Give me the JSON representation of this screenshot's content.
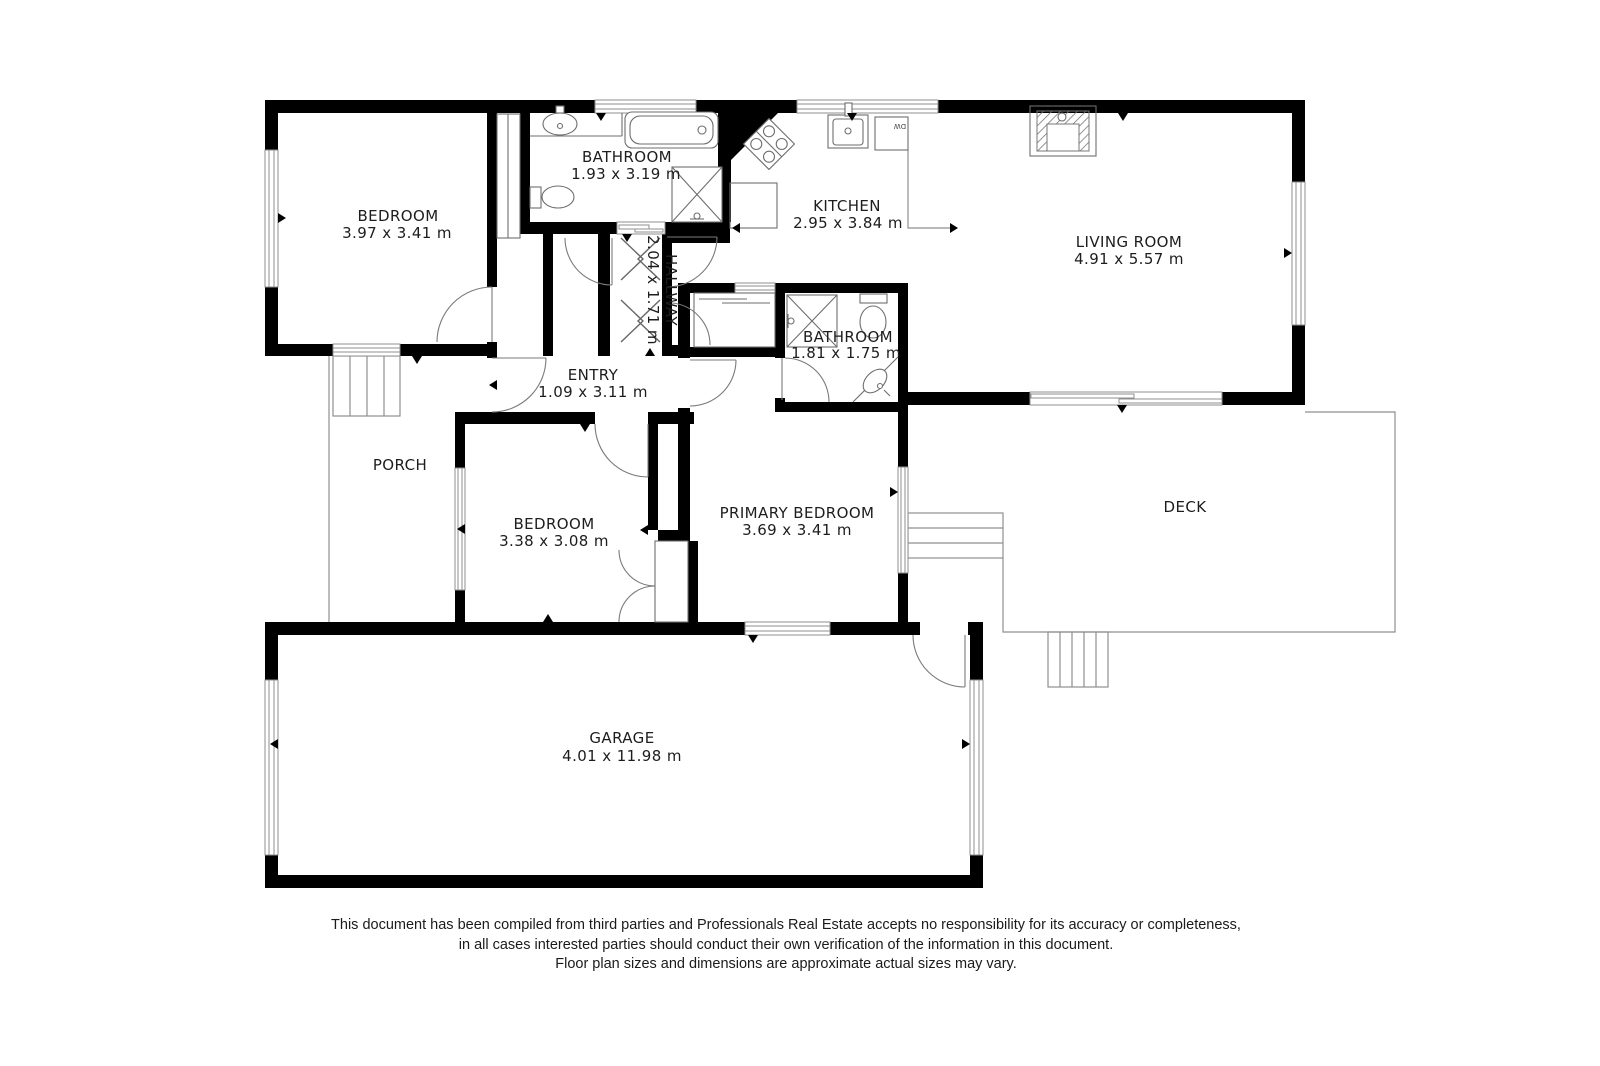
{
  "colors": {
    "bg": "#ffffff",
    "wall": "#000000",
    "line": "#8f8f8f",
    "fixture": "#6e6e6e",
    "text": "#1d1d1d"
  },
  "rooms": {
    "bedroom1": {
      "name": "BEDROOM",
      "dims": "3.97 x 3.41 m"
    },
    "bathroom1": {
      "name": "BATHROOM",
      "dims": "1.93 x 3.19 m"
    },
    "hallway": {
      "name": "HALLWAY",
      "dims": "2.04 x 1.71 m"
    },
    "kitchen": {
      "name": "KITCHEN",
      "dims": "2.95 x 3.84 m"
    },
    "living": {
      "name": "LIVING ROOM",
      "dims": "4.91 x 5.57 m"
    },
    "bathroom2": {
      "name": "BATHROOM",
      "dims": "1.81 x 1.75 m"
    },
    "entry": {
      "name": "ENTRY",
      "dims": "1.09 x 3.11 m"
    },
    "porch": {
      "name": "PORCH"
    },
    "bedroom2": {
      "name": "BEDROOM",
      "dims": "3.38 x 3.08 m"
    },
    "primary": {
      "name": "PRIMARY BEDROOM",
      "dims": "3.69 x 3.41 m"
    },
    "deck": {
      "name": "DECK"
    },
    "garage": {
      "name": "GARAGE",
      "dims": "4.01 x 11.98 m"
    }
  },
  "fixtures": {
    "bathroom1": [
      "sink-icon",
      "toilet-icon",
      "bathtub-icon",
      "shower-icon"
    ],
    "bathroom2": [
      "shower-icon",
      "toilet-icon",
      "corner-sink-icon"
    ],
    "kitchen": [
      "stove-icon",
      "kitchen-sink-icon",
      "dishwasher-icon",
      "counter-icon"
    ],
    "living": [
      "fireplace-icon"
    ],
    "labels": {
      "dishwasher": "DW"
    }
  },
  "disclaimer": [
    "This document has been compiled from third parties and Professionals Real Estate accepts no responsibility for its accuracy or completeness,",
    "in all cases interested parties should conduct their own verification of the information in this document.",
    "Floor plan sizes and dimensions are approximate actual sizes may vary."
  ]
}
